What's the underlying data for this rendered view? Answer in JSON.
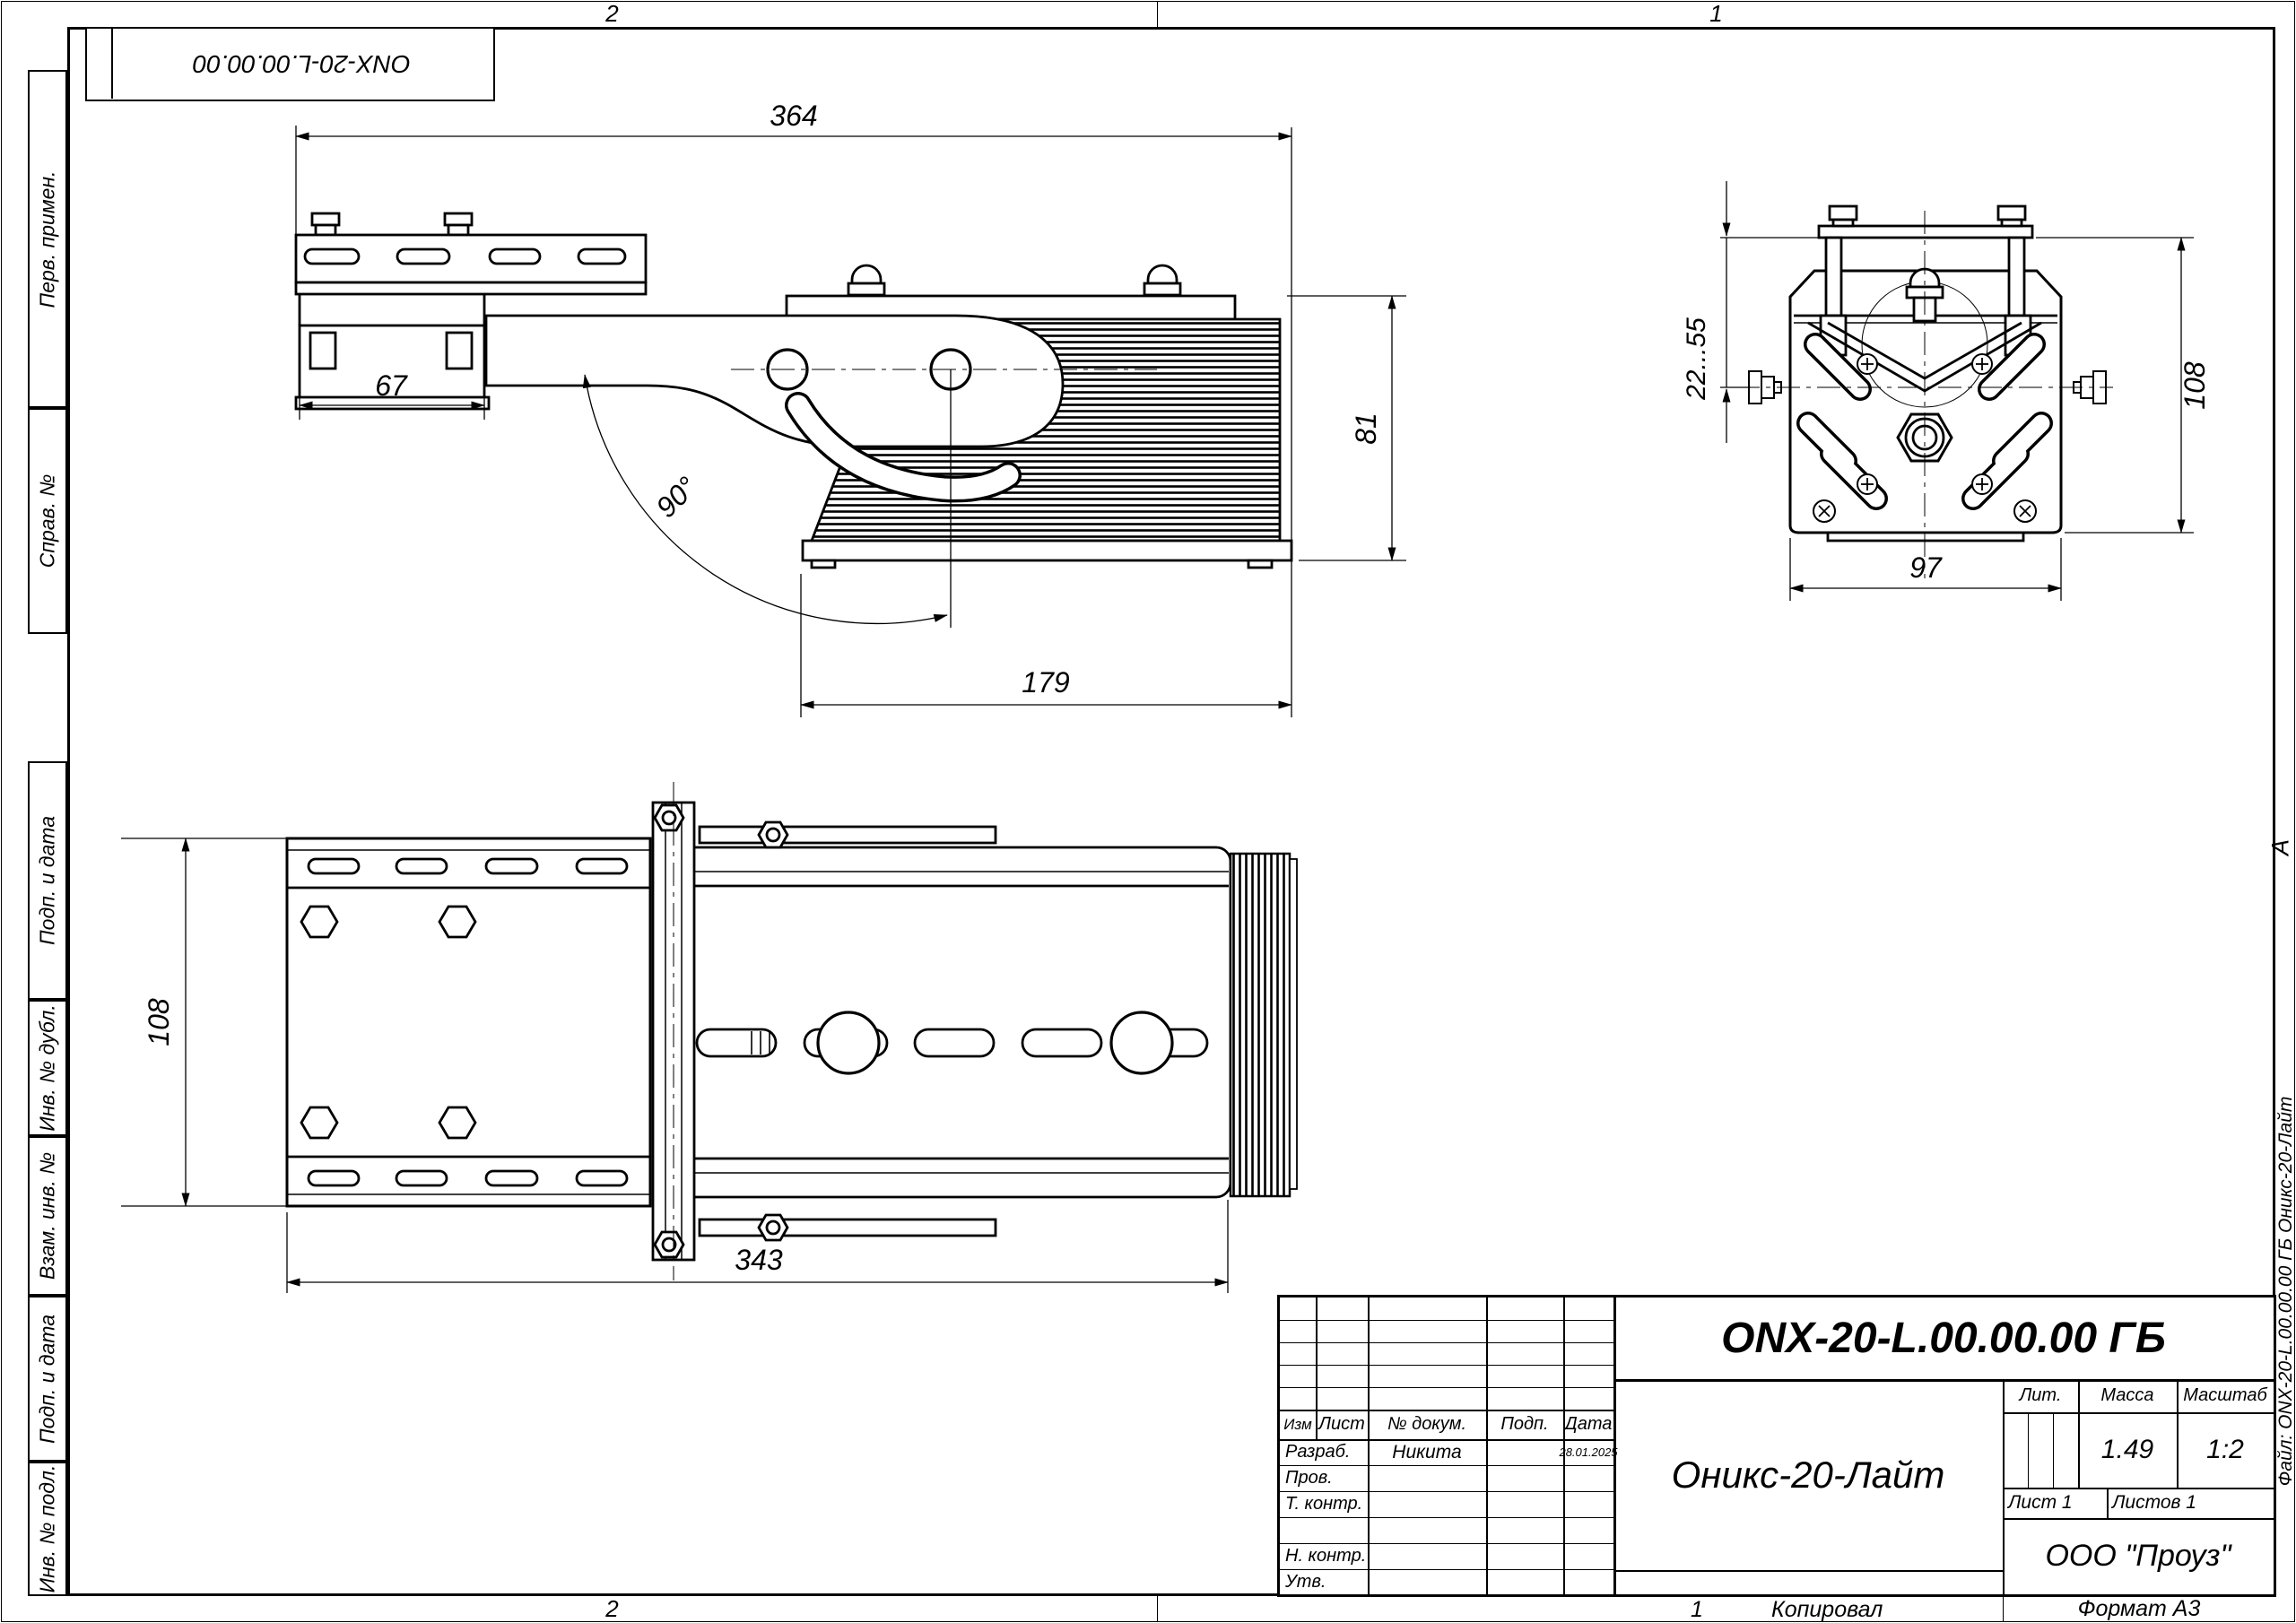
{
  "page": {
    "zone_top_left": "2",
    "zone_top_right": "1",
    "zone_bottom_left": "2",
    "zone_bottom_right": "1",
    "copied_label": "Копировал",
    "format_label": "Формат А3",
    "zone_marker": "А"
  },
  "top_stamp": {
    "designation": "ONX-20-L.00.00.00"
  },
  "file_note": "Файл: ONX-20-L.00.00.00 ГБ Оникс-20-Лайт",
  "side_stamps": [
    {
      "label": "Перв. примен."
    },
    {
      "label": "Справ. №"
    },
    {
      "label": "Подп. и дата"
    },
    {
      "label": "Инв. № дубл."
    },
    {
      "label": "Взам. инв. №"
    },
    {
      "label": "Подп. и дата"
    },
    {
      "label": "Инв. № подл."
    }
  ],
  "title_block": {
    "designation": "ONX-20-L.00.00.00 ГБ",
    "product_name": "Оникс-20-Лайт",
    "company": "ООО \"Проуз\"",
    "labels": {
      "izm": "Изм",
      "list": "Лист",
      "doc": "№ докум.",
      "podp": "Подп.",
      "data": "Дата",
      "lit": "Лит.",
      "massa": "Масса",
      "masshtab": "Масштаб"
    },
    "mass_value": "1.49",
    "scale_value": "1:2",
    "sheet_info": "Лист 1",
    "sheets_info": "Листов 1",
    "rows": [
      {
        "role": "Разраб.",
        "name": "Никита",
        "sign": "",
        "date": "28.01.2025"
      },
      {
        "role": "Пров.",
        "name": "",
        "sign": "",
        "date": ""
      },
      {
        "role": "Т. контр.",
        "name": "",
        "sign": "",
        "date": ""
      },
      {
        "role": "",
        "name": "",
        "sign": "",
        "date": ""
      },
      {
        "role": "Н. контр.",
        "name": "",
        "sign": "",
        "date": ""
      },
      {
        "role": "Утв.",
        "name": "",
        "sign": "",
        "date": ""
      }
    ]
  },
  "dimensions": {
    "side_view": {
      "overall_length": "364",
      "bracket_width": "67",
      "tilt_angle": "90°",
      "body_length": "179",
      "body_height": "81"
    },
    "front_view": {
      "adjust_range": "22...55",
      "height": "108",
      "width": "97"
    },
    "plan_view": {
      "width": "108",
      "length": "343"
    }
  }
}
